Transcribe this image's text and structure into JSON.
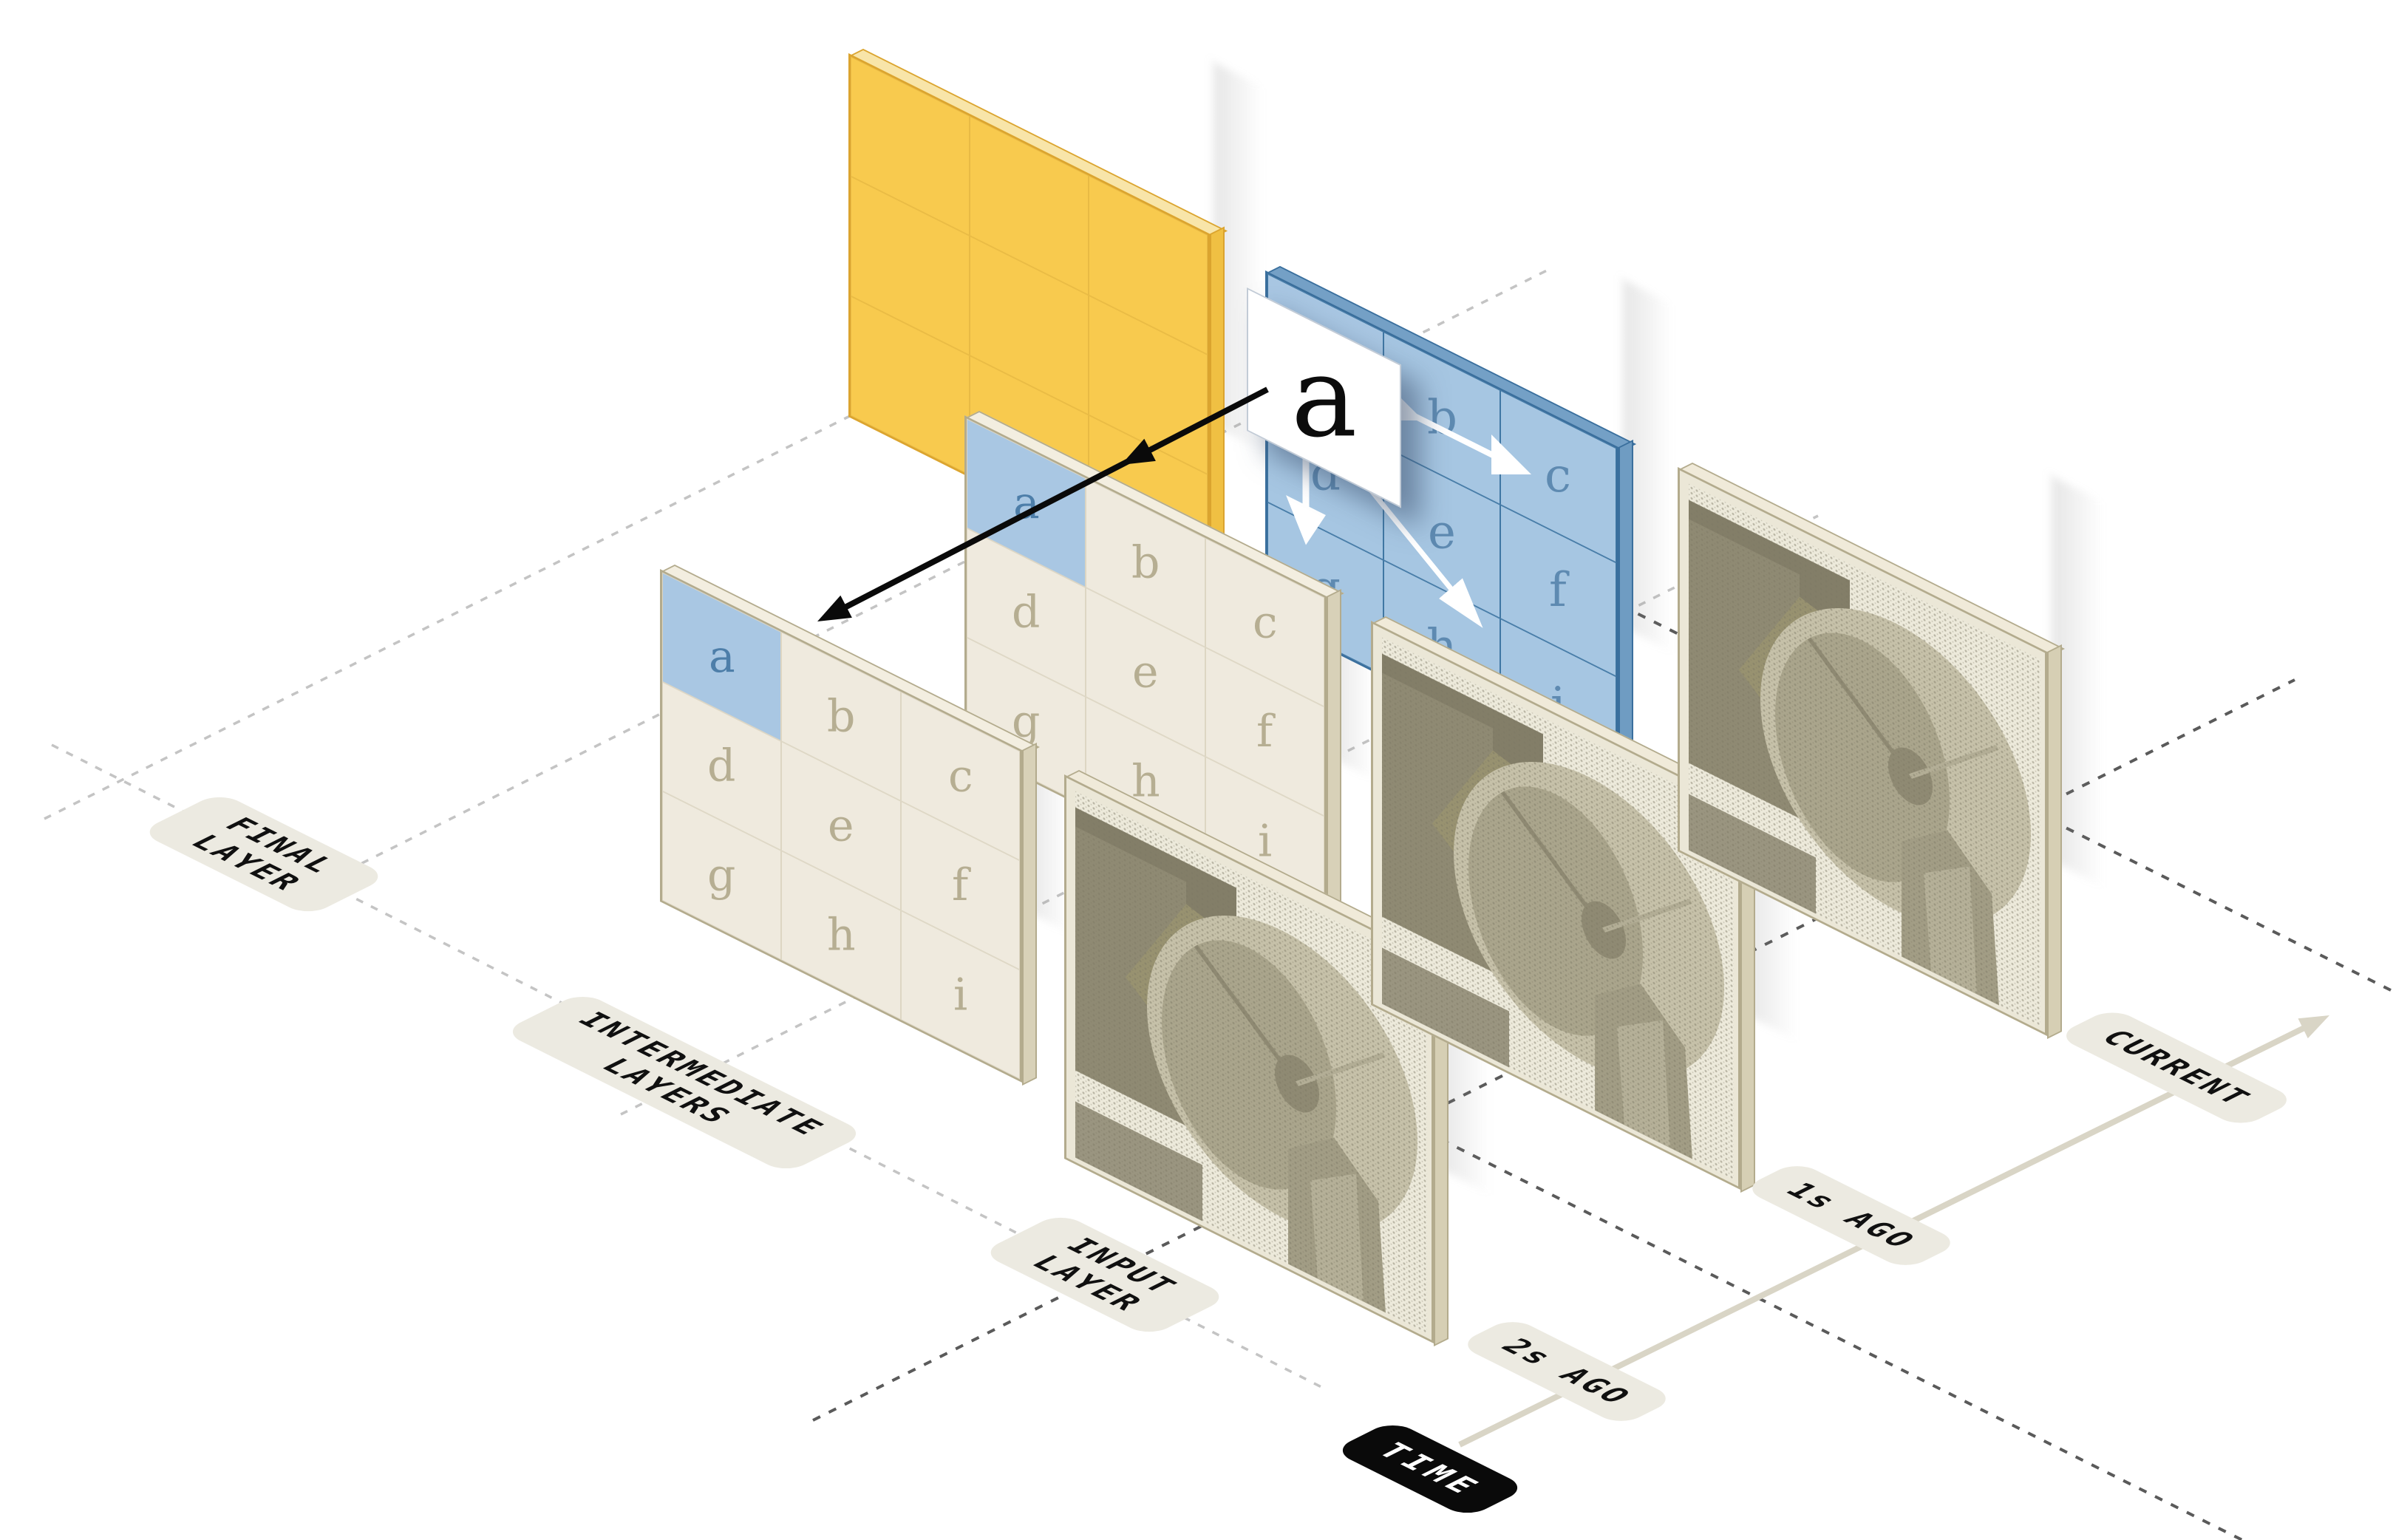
{
  "diagram": {
    "description": "isometric temporal convolution diagram",
    "cell_letters": [
      "a",
      "b",
      "c",
      "d",
      "e",
      "f",
      "g",
      "h",
      "i"
    ],
    "callout_letter": "a",
    "labels": {
      "final_layer": [
        "FINAL",
        "LAYER"
      ],
      "intermediate_layers": [
        "INTERMEDIATE",
        "LAYERS"
      ],
      "input_layer": [
        "INPUT",
        "LAYER"
      ],
      "time": "TIME",
      "time_ticks": [
        "2s AGO",
        "1s AGO",
        "CURRENT"
      ]
    },
    "colors": {
      "yellow-face": "#f8ca4e",
      "yellow-edge": "#dba42f",
      "yellow-top": "#f8e5a9",
      "yellow-side": "#f0c043",
      "yellow-grid": "#e8ba45",
      "blue-face": "#a6c6e2",
      "blue-edge": "#3a6f9d",
      "blue-top": "#74a0c6",
      "blue-side": "#6f9cc2",
      "blue-grid": "#4077a3",
      "blue-letter": "#5e8ab1",
      "cream-face": "#efeade",
      "cream-edge": "#b3ab8d",
      "cream-top": "#f3eee0",
      "cream-side": "#d8d1b8",
      "cream-grid": "#ddd6c3",
      "cream-letter": "#b6ae92",
      "input-face": "#ebe7d7",
      "input-top": "#f0ead9",
      "input-side": "#d6cfb4",
      "hl-cell": "#a9c7e3",
      "hl-border": "#4077a3",
      "hl-letter": "#4d7ea9",
      "pill-bg": "#eceae1",
      "pill-text": "#101010",
      "time-bg": "#0a0a0a",
      "time-text": "#ffffff",
      "axis": "#d9d5c6",
      "dash-light": "#c4c4c4",
      "dash-dark": "#5a5a5a",
      "callout-bg": "#ffffff",
      "arrow-black": "#0a0a0a",
      "arrow-white": "#ffffff"
    }
  }
}
